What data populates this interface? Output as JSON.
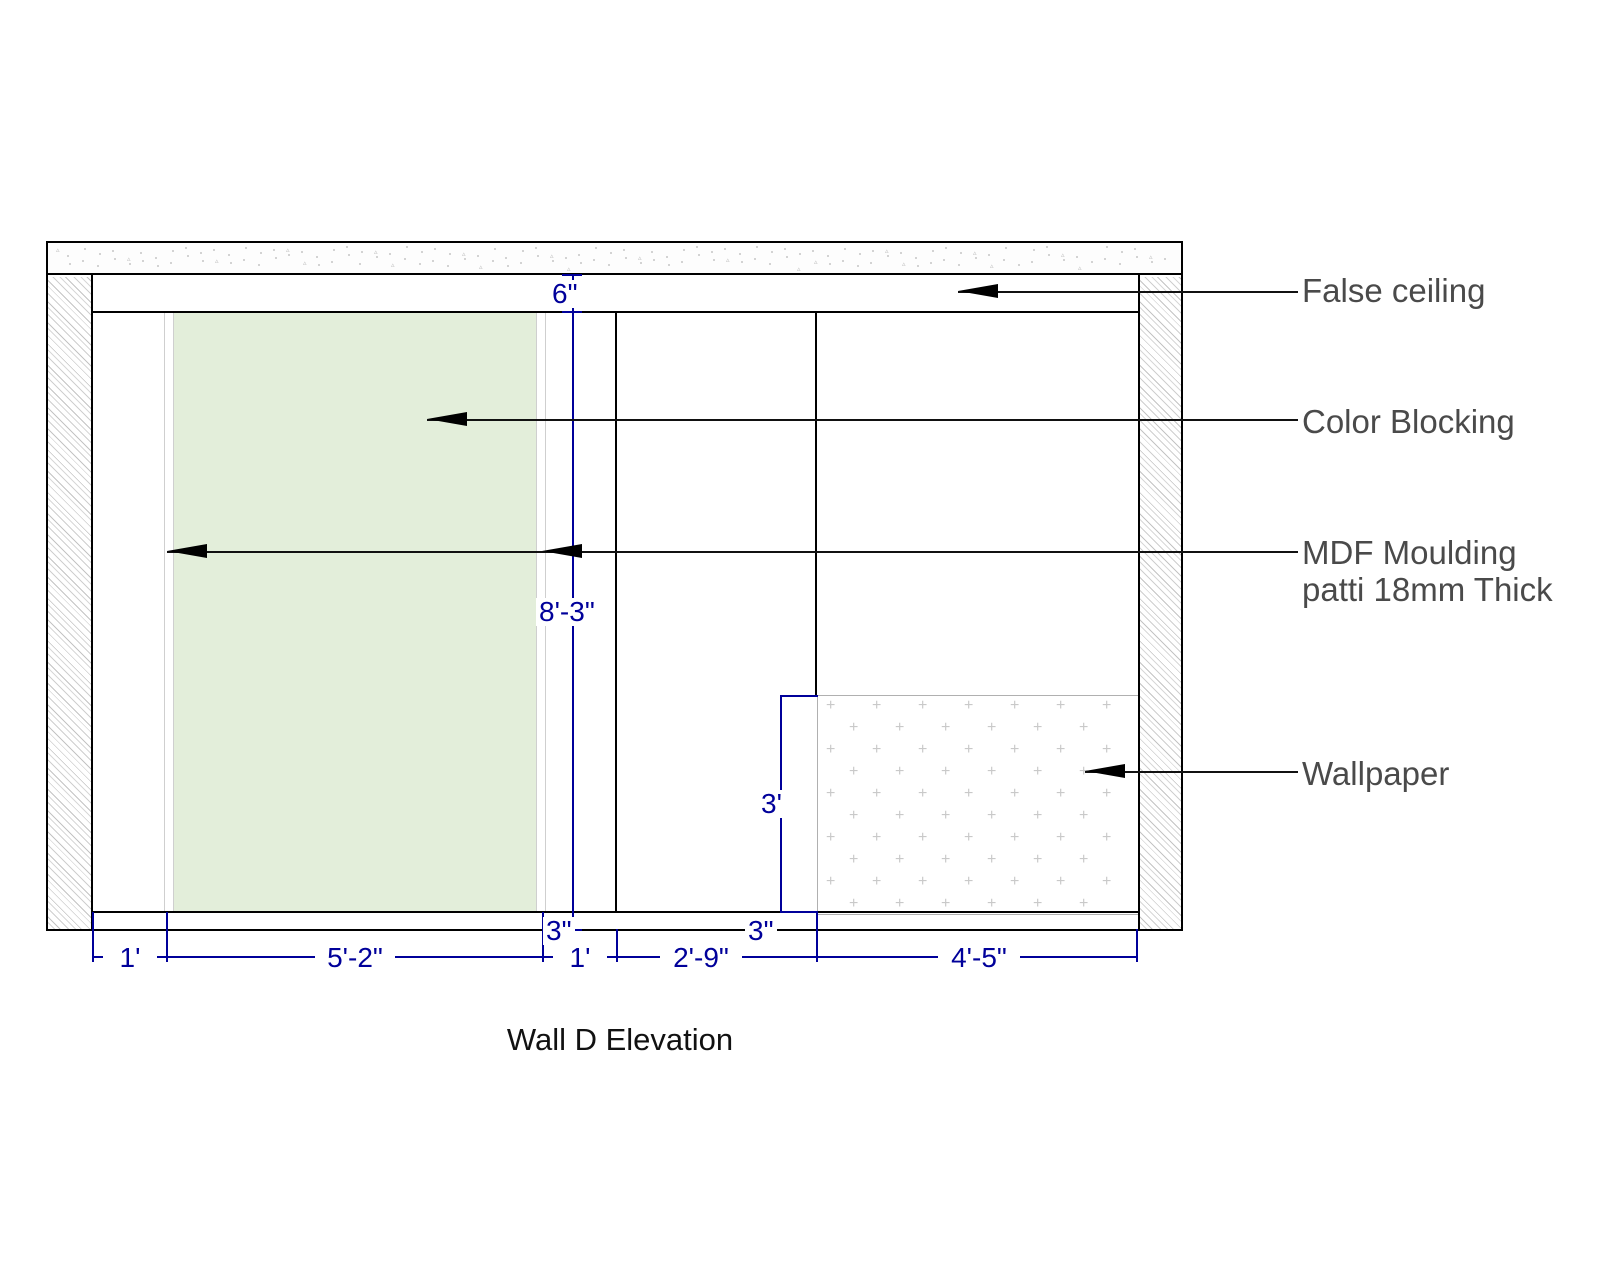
{
  "title": "Wall D Elevation",
  "annotations": {
    "false_ceiling": "False ceiling",
    "color_blocking": "Color Blocking",
    "mdf_moulding_line1": "MDF Moulding",
    "mdf_moulding_line2": "patti 18mm Thick",
    "wallpaper": "Wallpaper"
  },
  "dimensions": {
    "false_ceiling_drop": "6\"",
    "wall_height": "8'-3\"",
    "skirting_height_left": "3\"",
    "wallpaper_height": "3'",
    "skirting_height_right": "3\"",
    "bottom_left_margin": "1'",
    "color_block_width": "5'-2\"",
    "right_of_panel": "1'",
    "bottom_middle_span": "2'-9\"",
    "wallpaper_width": "4'-5\""
  },
  "colors": {
    "dimension_blue": "#00009a",
    "annotation_gray": "#4a4a4a",
    "color_block_green": "#e3eeda",
    "wall_line_black": "#000000",
    "hatch_gray": "#c4c4c4",
    "wallpaper_plus_gray": "#c9c9c9"
  }
}
